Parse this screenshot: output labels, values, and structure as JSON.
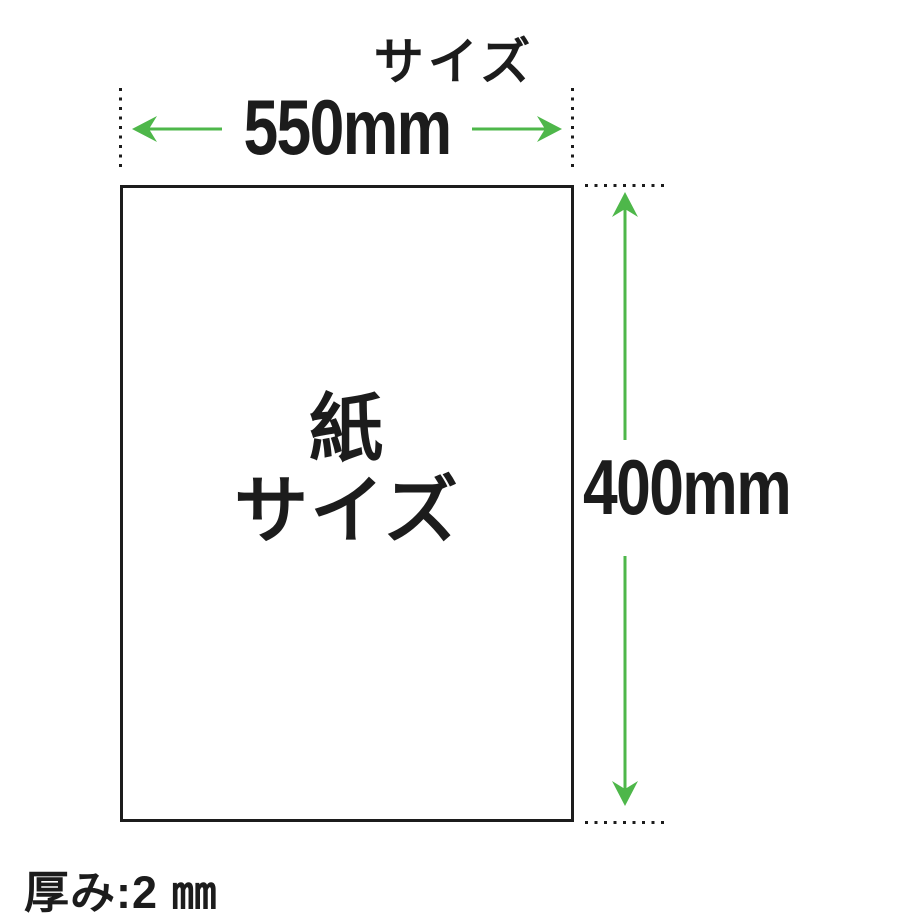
{
  "canvas": {
    "width_px": 901,
    "height_px": 922,
    "background": "#ffffff"
  },
  "colors": {
    "ink": "#1c1c1c",
    "green": "#4eb74a"
  },
  "diagram": {
    "title": "サイズ",
    "width_dimension": "550mm",
    "height_dimension": "400mm",
    "paper_label_line1": "紙",
    "paper_label_line2": "サイズ",
    "thickness_note": "厚み:2 ㎜"
  }
}
